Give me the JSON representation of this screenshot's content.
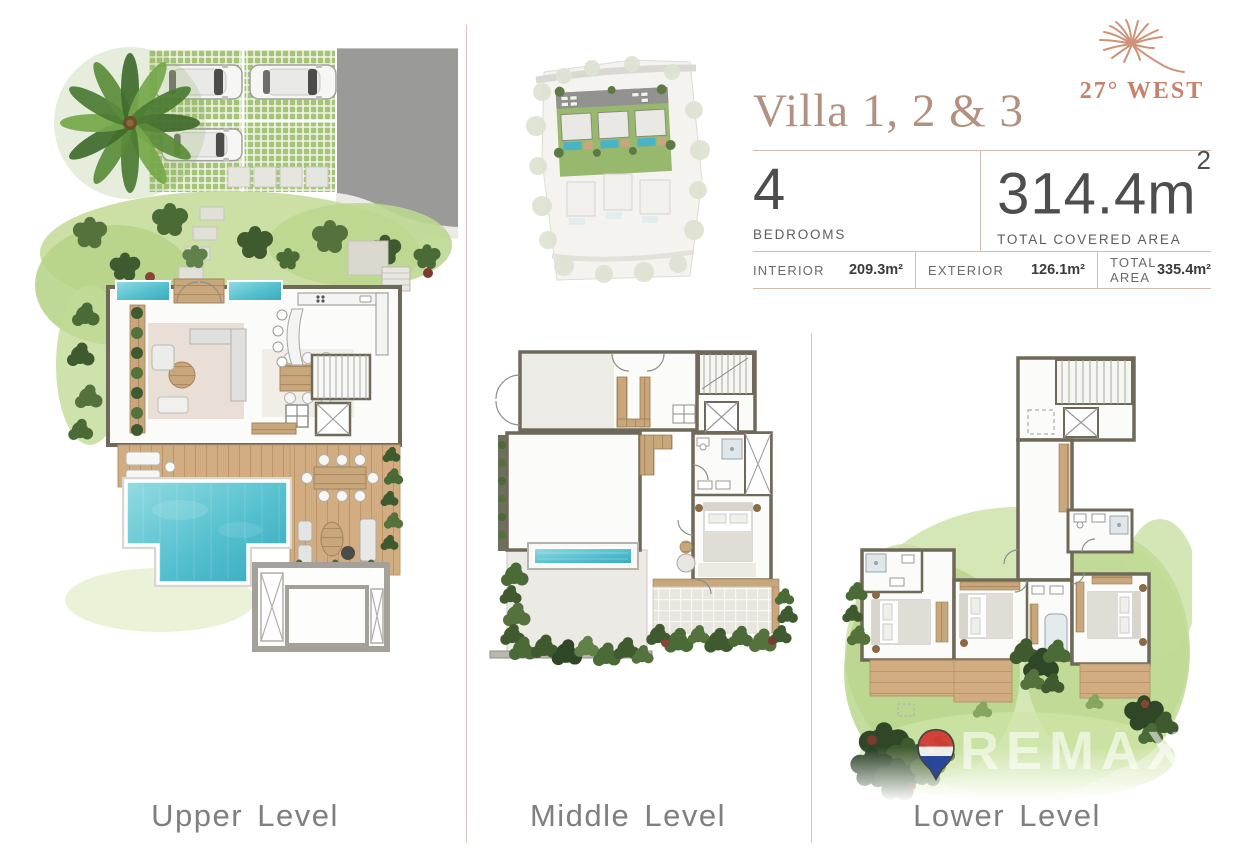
{
  "brand": {
    "name": "27° WEST",
    "logo_icon": "palm-frond-icon"
  },
  "header": {
    "title": "Villa 1, 2 & 3",
    "bedrooms_value": "4",
    "bedrooms_label": "BEDROOMS",
    "covered_value": "314.4m",
    "covered_sup": "2",
    "covered_label": "TOTAL COVERED AREA",
    "stats": [
      {
        "label": "INTERIOR",
        "value": "209.3m²"
      },
      {
        "label": "EXTERIOR",
        "value": "126.1m²"
      },
      {
        "label": "TOTAL AREA",
        "value": "335.4m²"
      }
    ]
  },
  "levels": [
    {
      "label": "Upper Level"
    },
    {
      "label": "Middle Level"
    },
    {
      "label": "Lower Level"
    }
  ],
  "watermark": {
    "brand": "REMAX",
    "suffix": "24",
    "pin_icon": "remax-balloon-icon"
  },
  "colors": {
    "accent_salmon": "#c4836a",
    "title_taupe": "#b29180",
    "rule_tan": "#d9c4b7",
    "label_gray": "#7f7f7f",
    "pool_cyan": "#55c0cf",
    "grass_green": "#a6c477",
    "wood_tan": "#c9a77c",
    "wall_gray": "#6f6959",
    "road_gray": "#9a9a98",
    "remax_red": "#d23b34",
    "remax_blue": "#24439b"
  }
}
